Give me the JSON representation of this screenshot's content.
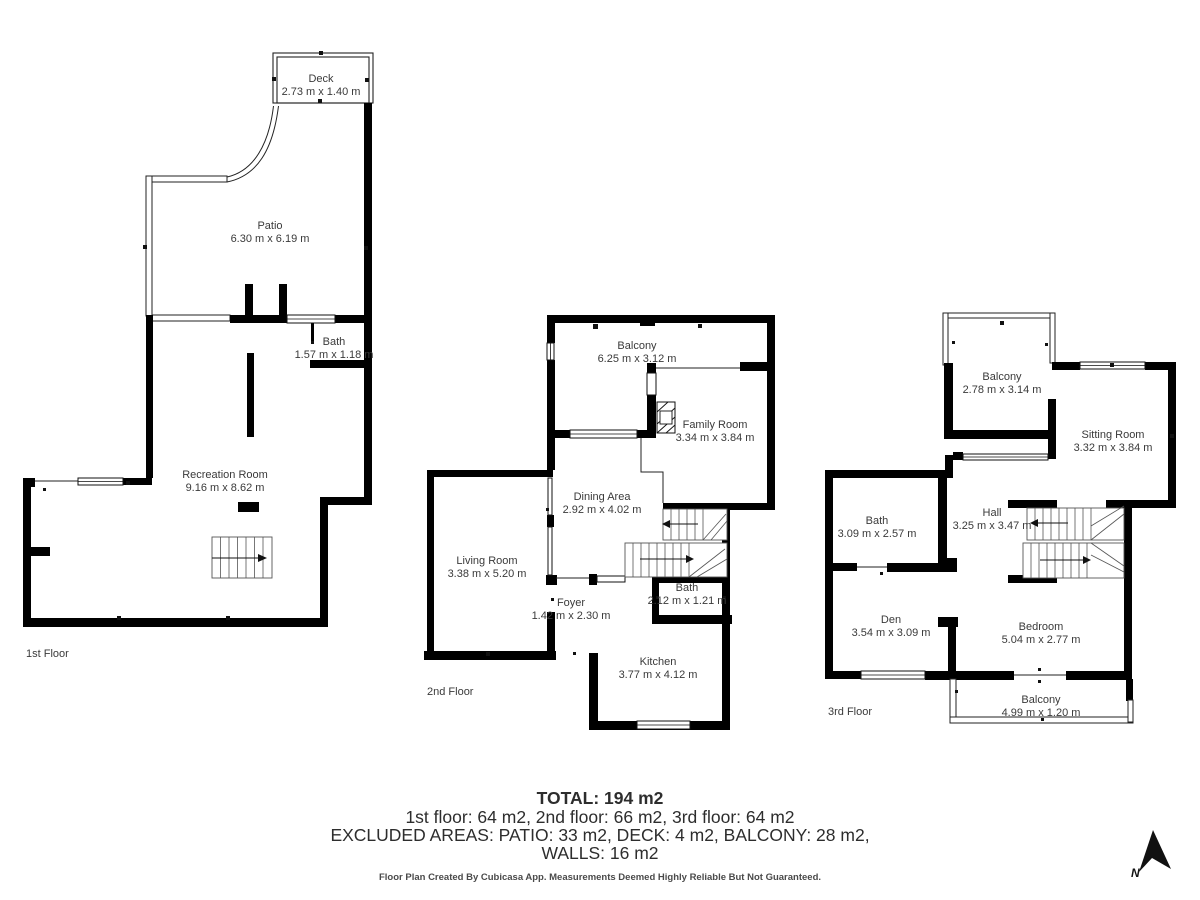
{
  "page": {
    "background": "#ffffff",
    "wall_color": "#000000",
    "label_color": "#3a3a3a"
  },
  "floors": [
    {
      "label": "1st Floor",
      "rooms": [
        {
          "name": "Deck",
          "dims": "2.73 m x 1.40 m"
        },
        {
          "name": "Patio",
          "dims": "6.30 m x 6.19 m"
        },
        {
          "name": "Bath",
          "dims": "1.57 m x 1.18 m"
        },
        {
          "name": "Recreation Room",
          "dims": "9.16 m x 8.62 m"
        }
      ]
    },
    {
      "label": "2nd Floor",
      "rooms": [
        {
          "name": "Balcony",
          "dims": "6.25 m x 3.12 m"
        },
        {
          "name": "Family Room",
          "dims": "3.34 m x 3.84 m"
        },
        {
          "name": "Dining Area",
          "dims": "2.92 m x 4.02 m"
        },
        {
          "name": "Living Room",
          "dims": "3.38 m x 5.20 m"
        },
        {
          "name": "Foyer",
          "dims": "1.42 m x 2.30 m"
        },
        {
          "name": "Bath",
          "dims": "2.12 m x 1.21 m"
        },
        {
          "name": "Kitchen",
          "dims": "3.77 m x 4.12 m"
        }
      ]
    },
    {
      "label": "3rd Floor",
      "rooms": [
        {
          "name": "Balcony",
          "dims": "2.78 m x 3.14 m"
        },
        {
          "name": "Sitting Room",
          "dims": "3.32 m x 3.84 m"
        },
        {
          "name": "Bath",
          "dims": "3.09 m x 2.57 m"
        },
        {
          "name": "Hall",
          "dims": "3.25 m x 3.47 m"
        },
        {
          "name": "Den",
          "dims": "3.54 m x 3.09 m"
        },
        {
          "name": "Bedroom",
          "dims": "5.04 m x 2.77 m"
        },
        {
          "name": "Balcony",
          "dims": "4.99 m x 1.20 m"
        }
      ]
    }
  ],
  "summary": {
    "total_line": "TOTAL: 194 m2",
    "floors_line": "1st floor: 64 m2, 2nd floor: 66 m2, 3rd floor: 64 m2",
    "excluded_line": "EXCLUDED AREAS: PATIO: 33 m2, DECK: 4 m2, BALCONY: 28 m2,",
    "walls_line": "WALLS: 16 m2"
  },
  "footer": {
    "credit": "Floor Plan Created By Cubicasa App. Measurements Deemed Highly Reliable But Not Guaranteed."
  },
  "compass": {
    "label": "N"
  }
}
